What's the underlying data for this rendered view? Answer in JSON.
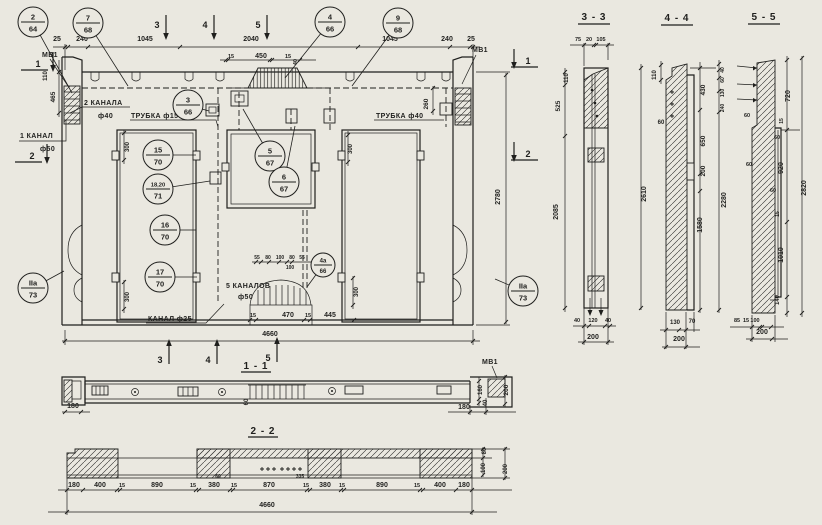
{
  "palette": {
    "paper": "#eae8e0",
    "ink": "#1f1f1d"
  },
  "titles": {
    "t11": "1 - 1",
    "t22": "2 - 2",
    "t33": "3 - 3",
    "t44": "4 - 4",
    "t55": "5 - 5"
  },
  "labels": {
    "mv1_top_left": "МВ1",
    "mv1_top_right": "МВ1",
    "mv1_s11": "МВ1",
    "kanala2": "2 КАНАЛА",
    "kanala2_d": "ф40",
    "trubka15": "ТРУБКА ф15",
    "trubka40": "ТРУБКА ф40",
    "kanal1": "1 КАНАЛ",
    "kanal1_d": "ф50",
    "kanal25": "КАНАЛ ф25",
    "kanalov5": "5 КАНАЛОВ",
    "kanalov5_d": "ф50"
  },
  "callouts": [
    {
      "n": "2",
      "d": "64",
      "x": 33,
      "y": 22,
      "lx": 72,
      "ly": 93
    },
    {
      "n": "7",
      "d": "68",
      "x": 88,
      "y": 23,
      "lx": 128,
      "ly": 86
    },
    {
      "n": "4",
      "d": "66",
      "x": 330,
      "y": 22,
      "lx": 285,
      "ly": 78
    },
    {
      "n": "9",
      "d": "68",
      "x": 398,
      "y": 23,
      "lx": 352,
      "ly": 86
    },
    {
      "n": "3",
      "d": "66",
      "x": 188,
      "y": 105,
      "lx": 209,
      "ly": 111
    },
    {
      "n": "15",
      "d": "70",
      "x": 158,
      "y": 155,
      "lx": 196,
      "ly": 155
    },
    {
      "n": "18,20",
      "d": "71",
      "x": 158,
      "y": 189,
      "lx": 210,
      "ly": 181
    },
    {
      "n": "5",
      "d": "67",
      "x": 270,
      "y": 156,
      "lx": 243,
      "ly": 109
    },
    {
      "n": "6",
      "d": "67",
      "x": 284,
      "y": 182,
      "lx": 295,
      "ly": 126
    },
    {
      "n": "16",
      "d": "70",
      "x": 165,
      "y": 230,
      "lx": 196,
      "ly": 230
    },
    {
      "n": "17",
      "d": "70",
      "x": 160,
      "y": 277,
      "lx": 197,
      "ly": 277
    },
    {
      "n": "4а",
      "d": "66",
      "x": 323,
      "y": 265,
      "r": 12,
      "lx": 307,
      "ly": 287
    },
    {
      "n": "IIа",
      "d": "73",
      "x": 33,
      "y": 288,
      "lx": 64,
      "ly": 271
    },
    {
      "n": "IIа",
      "d": "73",
      "x": 523,
      "y": 291,
      "lx": 495,
      "ly": 279
    }
  ],
  "marks": [
    {
      "t": "3",
      "x": 157,
      "y": 25,
      "k": "t"
    },
    {
      "t": "4",
      "x": 205,
      "y": 25,
      "k": "t"
    },
    {
      "t": "5",
      "x": 258,
      "y": 25,
      "k": "t"
    },
    {
      "t": "3",
      "x": 160,
      "y": 360,
      "k": "b"
    },
    {
      "t": "4",
      "x": 208,
      "y": 360,
      "k": "b"
    },
    {
      "t": "5",
      "x": 268,
      "y": 358,
      "k": "b"
    },
    {
      "t": "1",
      "x": 38,
      "y": 64,
      "k": "s",
      "a": "r"
    },
    {
      "t": "2",
      "x": 32,
      "y": 156,
      "k": "s",
      "a": "r"
    },
    {
      "t": "1",
      "x": 528,
      "y": 61,
      "k": "s",
      "a": "l"
    },
    {
      "t": "2",
      "x": 528,
      "y": 154,
      "k": "s",
      "a": "l"
    }
  ],
  "dims": [
    {
      "t": "25",
      "x": 57,
      "y": 41
    },
    {
      "t": "240",
      "x": 82,
      "y": 41
    },
    {
      "t": "1045",
      "x": 145,
      "y": 41
    },
    {
      "t": "2040",
      "x": 251,
      "y": 41
    },
    {
      "t": "1045",
      "x": 390,
      "y": 41
    },
    {
      "t": "240",
      "x": 447,
      "y": 41
    },
    {
      "t": "25",
      "x": 471,
      "y": 41
    },
    {
      "t": "15",
      "x": 231,
      "y": 58,
      "fs": 5.5
    },
    {
      "t": "450",
      "x": 261,
      "y": 58
    },
    {
      "t": "15",
      "x": 288,
      "y": 58,
      "fs": 5.5
    },
    {
      "t": "40",
      "x": 297,
      "y": 62,
      "r": 1,
      "fs": 5.5
    },
    {
      "t": "260",
      "x": 428,
      "y": 104,
      "r": 1,
      "fs": 6.5
    },
    {
      "t": "465",
      "x": 55,
      "y": 97,
      "r": 1,
      "fs": 6.5
    },
    {
      "t": "110",
      "x": 47,
      "y": 76,
      "r": 1,
      "fs": 6
    },
    {
      "t": "2780",
      "x": 500,
      "y": 197,
      "r": 1
    },
    {
      "t": "300",
      "x": 129,
      "y": 147,
      "r": 1,
      "fs": 6
    },
    {
      "t": "300",
      "x": 352,
      "y": 149,
      "r": 1,
      "fs": 6
    },
    {
      "t": "300",
      "x": 129,
      "y": 297,
      "r": 1,
      "fs": 6
    },
    {
      "t": "300",
      "x": 358,
      "y": 292,
      "r": 1,
      "fs": 6
    },
    {
      "t": "55",
      "x": 257,
      "y": 259,
      "fs": 5
    },
    {
      "t": "80",
      "x": 268,
      "y": 259,
      "fs": 5
    },
    {
      "t": "100",
      "x": 280,
      "y": 259,
      "fs": 5
    },
    {
      "t": "80",
      "x": 292,
      "y": 259,
      "fs": 5
    },
    {
      "t": "55",
      "x": 302,
      "y": 259,
      "fs": 5
    },
    {
      "t": "100",
      "x": 290,
      "y": 269,
      "fs": 5
    },
    {
      "t": "15",
      "x": 253,
      "y": 317,
      "fs": 5.5
    },
    {
      "t": "470",
      "x": 288,
      "y": 317
    },
    {
      "t": "15",
      "x": 308,
      "y": 317,
      "fs": 5.5
    },
    {
      "t": "445",
      "x": 330,
      "y": 317
    },
    {
      "t": "4660",
      "x": 270,
      "y": 336
    },
    {
      "t": "180",
      "x": 73,
      "y": 408
    },
    {
      "t": "60",
      "x": 248,
      "y": 402,
      "r": 1,
      "fs": 6
    },
    {
      "t": "180",
      "x": 464,
      "y": 409
    },
    {
      "t": "160",
      "x": 482,
      "y": 390,
      "r": 1,
      "fs": 6
    },
    {
      "t": "40",
      "x": 487,
      "y": 403,
      "r": 1,
      "fs": 6
    },
    {
      "t": "200",
      "x": 508,
      "y": 390,
      "r": 1,
      "fs": 6.5
    },
    {
      "t": "180",
      "x": 74,
      "y": 487
    },
    {
      "t": "400",
      "x": 100,
      "y": 487
    },
    {
      "t": "15",
      "x": 122,
      "y": 487,
      "fs": 5.5
    },
    {
      "t": "890",
      "x": 157,
      "y": 487
    },
    {
      "t": "15",
      "x": 193,
      "y": 487,
      "fs": 5.5
    },
    {
      "t": "380",
      "x": 214,
      "y": 487
    },
    {
      "t": "15",
      "x": 234,
      "y": 487,
      "fs": 5.5
    },
    {
      "t": "870",
      "x": 269,
      "y": 487
    },
    {
      "t": "15",
      "x": 306,
      "y": 487,
      "fs": 5.5
    },
    {
      "t": "380",
      "x": 325,
      "y": 487
    },
    {
      "t": "15",
      "x": 342,
      "y": 487,
      "fs": 5.5
    },
    {
      "t": "890",
      "x": 382,
      "y": 487
    },
    {
      "t": "15",
      "x": 417,
      "y": 487,
      "fs": 5.5
    },
    {
      "t": "400",
      "x": 440,
      "y": 487
    },
    {
      "t": "180",
      "x": 464,
      "y": 487
    },
    {
      "t": "60",
      "x": 218,
      "y": 478,
      "fs": 5
    },
    {
      "t": "335",
      "x": 300,
      "y": 478,
      "fs": 5
    },
    {
      "t": "4660",
      "x": 267,
      "y": 507
    },
    {
      "t": "80",
      "x": 486,
      "y": 451,
      "r": 1,
      "fs": 6
    },
    {
      "t": "100",
      "x": 485,
      "y": 468,
      "r": 1,
      "fs": 6
    },
    {
      "t": "200",
      "x": 507,
      "y": 469,
      "r": 1,
      "fs": 6
    },
    {
      "t": "75",
      "x": 578,
      "y": 41,
      "fs": 5.5
    },
    {
      "t": "20",
      "x": 589,
      "y": 41,
      "fs": 5.5
    },
    {
      "t": "105",
      "x": 601,
      "y": 41,
      "fs": 5.5
    },
    {
      "t": "110",
      "x": 568,
      "y": 78,
      "r": 1,
      "fs": 6
    },
    {
      "t": "525",
      "x": 560,
      "y": 106,
      "r": 1,
      "fs": 6.5
    },
    {
      "t": "2085",
      "x": 558,
      "y": 212,
      "r": 1
    },
    {
      "t": "2610",
      "x": 646,
      "y": 194,
      "r": 1
    },
    {
      "t": "40",
      "x": 577,
      "y": 322,
      "fs": 5.5
    },
    {
      "t": "120",
      "x": 593,
      "y": 322,
      "fs": 5.5
    },
    {
      "t": "40",
      "x": 608,
      "y": 322,
      "fs": 5.5
    },
    {
      "t": "200",
      "x": 593,
      "y": 339
    },
    {
      "t": "110",
      "x": 656,
      "y": 75,
      "r": 1,
      "fs": 6
    },
    {
      "t": "60",
      "x": 661,
      "y": 124,
      "fs": 6
    },
    {
      "t": "430",
      "x": 705,
      "y": 90,
      "r": 1,
      "fs": 6.5
    },
    {
      "t": "650",
      "x": 705,
      "y": 141,
      "r": 1,
      "fs": 6.5
    },
    {
      "t": "200",
      "x": 705,
      "y": 171,
      "r": 1,
      "fs": 6.5
    },
    {
      "t": "1580",
      "x": 702,
      "y": 225,
      "r": 1
    },
    {
      "t": "2280",
      "x": 726,
      "y": 200,
      "r": 1
    },
    {
      "t": "40",
      "x": 724,
      "y": 70,
      "r": 1,
      "fs": 5
    },
    {
      "t": "60",
      "x": 724,
      "y": 80,
      "r": 1,
      "fs": 5
    },
    {
      "t": "130",
      "x": 724,
      "y": 93,
      "r": 1,
      "fs": 5
    },
    {
      "t": "240",
      "x": 724,
      "y": 108,
      "r": 1,
      "fs": 5
    },
    {
      "t": "130",
      "x": 675,
      "y": 324,
      "fs": 6
    },
    {
      "t": "70",
      "x": 692,
      "y": 323,
      "fs": 6
    },
    {
      "t": "200",
      "x": 679,
      "y": 341
    },
    {
      "t": "720",
      "x": 790,
      "y": 96,
      "r": 1
    },
    {
      "t": "15",
      "x": 783,
      "y": 121,
      "r": 1,
      "fs": 5
    },
    {
      "t": "60",
      "x": 777,
      "y": 139,
      "fs": 5.5
    },
    {
      "t": "920",
      "x": 783,
      "y": 168,
      "r": 1
    },
    {
      "t": "60",
      "x": 747,
      "y": 117,
      "fs": 5.5
    },
    {
      "t": "60",
      "x": 749,
      "y": 166,
      "fs": 5.5
    },
    {
      "t": "60",
      "x": 773,
      "y": 192,
      "fs": 5.5
    },
    {
      "t": "15",
      "x": 779,
      "y": 214,
      "r": 1,
      "fs": 5
    },
    {
      "t": "1010",
      "x": 783,
      "y": 255,
      "r": 1
    },
    {
      "t": "140",
      "x": 779,
      "y": 300,
      "r": 1,
      "fs": 6
    },
    {
      "t": "2820",
      "x": 806,
      "y": 188,
      "r": 1
    },
    {
      "t": "85",
      "x": 737,
      "y": 322,
      "fs": 5.5
    },
    {
      "t": "15",
      "x": 746,
      "y": 322,
      "fs": 5.5
    },
    {
      "t": "100",
      "x": 755,
      "y": 322,
      "fs": 5.5
    },
    {
      "t": "200",
      "x": 762,
      "y": 334
    }
  ]
}
